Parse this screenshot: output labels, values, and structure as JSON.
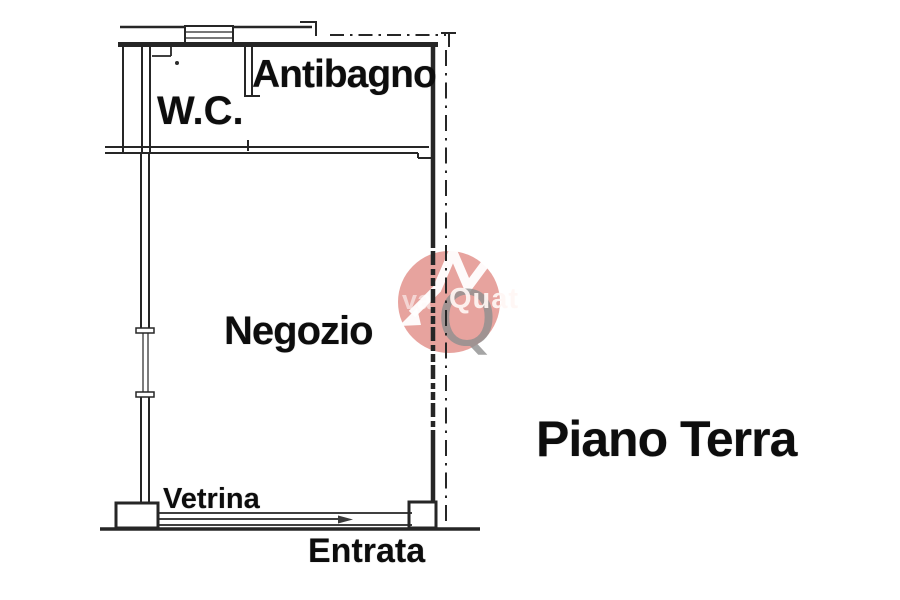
{
  "document": {
    "kind": "scanned floor plan",
    "background_color": "#ffffff",
    "line_color": "#262626",
    "text_color": "#0d0d0d"
  },
  "plan": {
    "rooms": [
      {
        "key": "wc",
        "label": "W.C."
      },
      {
        "key": "antibagno",
        "label": "Antibagno"
      },
      {
        "key": "negozio",
        "label": "Negozio"
      }
    ],
    "features": [
      {
        "key": "vetrina",
        "label": "Vetrina"
      },
      {
        "key": "entrata",
        "label": "Entrata"
      }
    ],
    "floor_title": "Piano Terra"
  },
  "watermark": {
    "circle_color": "#d0473d",
    "q_color": "#8e8e8e",
    "logo_mark": "arrow-N monogram",
    "q_letter": "Q",
    "text_faint_left": "va",
    "text_fragment": "Quat"
  }
}
